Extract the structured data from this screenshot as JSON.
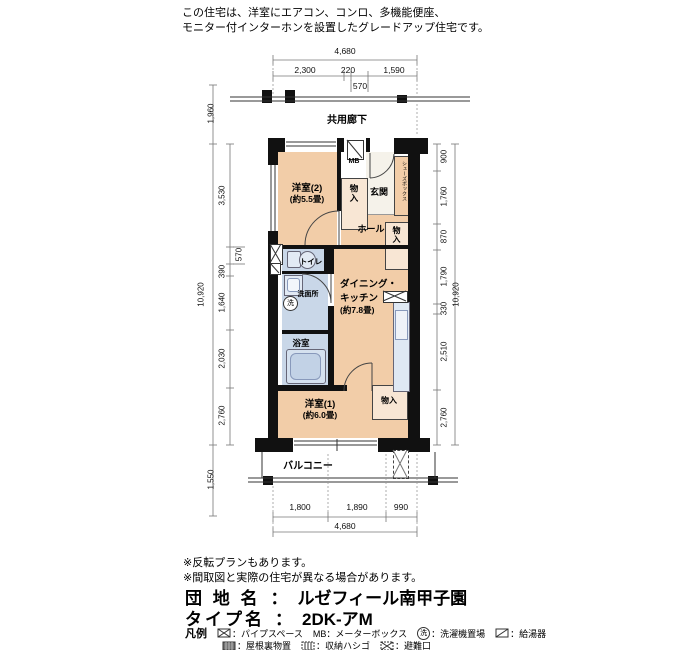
{
  "header": {
    "line1": "この住宅は、洋室にエアコン、コンロ、多機能便座、",
    "line2": "モニター付インターホンを設置したグレードアップ住宅です。"
  },
  "plan": {
    "corridor_label": "共用廊下",
    "rooms": {
      "yoshitsu2_name": "洋室(2)",
      "yoshitsu2_size": "(約5.5畳)",
      "mb": "MB",
      "genkan": "玄関",
      "hall": "ホール",
      "shoes_box": "シューズボックス",
      "mono_iri_1": "物入",
      "mono_iri_2": "物入",
      "mono_iri_3": "物入",
      "toilet": "トイレ",
      "washroom": "洗面所",
      "laundry": "洗",
      "bath": "浴室",
      "dk_line1": "ダイニング・",
      "dk_line2": "キッチン",
      "dk_size": "(約7.8畳)",
      "yoshitsu1_name": "洋室(1)",
      "yoshitsu1_size": "(約6.0畳)",
      "balcony": "バルコニー"
    },
    "dims": {
      "top_total": "4,680",
      "top_segs": [
        "2,300",
        "220",
        "1,590"
      ],
      "top_sub": "570",
      "left_outer_top": "1,960",
      "left_total": "10,920",
      "left_segs": [
        "3,530",
        "570",
        "390",
        "1,640",
        "2,030",
        "2,760"
      ],
      "left_outer_bottom": "1,550",
      "right_segs": [
        "900",
        "1,760",
        "870",
        "1,790",
        "330",
        "2,510",
        "2,760"
      ],
      "right_total": "10,920",
      "bottom_segs": [
        "1,800",
        "1,890",
        "990"
      ],
      "bottom_total": "4,680"
    }
  },
  "notes": [
    "※反転プランもあります。",
    "※間取図と実際の住宅が異なる場合があります。"
  ],
  "estate": {
    "label": "団 地 名",
    "sep": "：",
    "value": "ルゼフィール南甲子園"
  },
  "type": {
    "label": "タイプ名",
    "sep": "：",
    "value": "2DK-アM"
  },
  "legend": {
    "title": "凡例",
    "laundry_char": "洗",
    "row1": [
      {
        "text": "：パイプスペース"
      },
      {
        "text": "MB：メーターボックス"
      },
      {
        "text": "：洗濯機置場"
      },
      {
        "text": "：給湯器"
      }
    ],
    "row2": [
      {
        "text": "：屋根裏物置"
      },
      {
        "text": "：収納ハシゴ"
      },
      {
        "text": "：避難口"
      }
    ]
  },
  "colors": {
    "room_pink": "#f2cda8",
    "closet_pink": "#f8e6d4",
    "wet_blue": "#c9d7e8",
    "fixture_blue": "#e2eaf4",
    "genkan_floor": "#f5f2ea",
    "wall": "#111111"
  }
}
